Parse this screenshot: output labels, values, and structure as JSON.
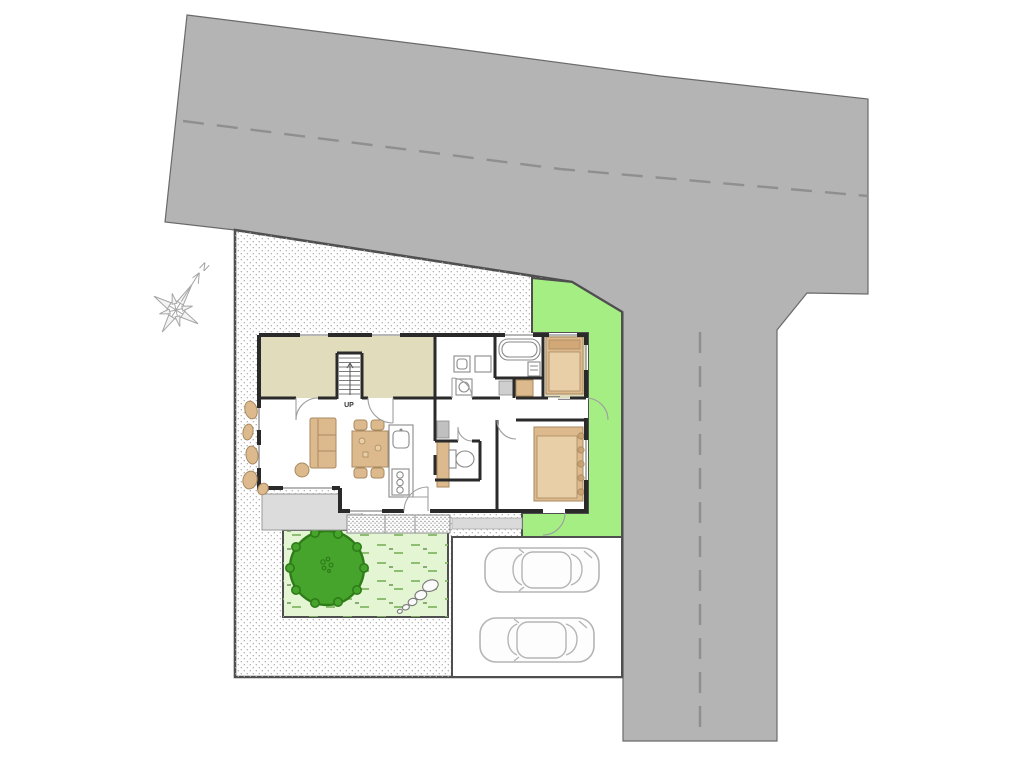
{
  "drawing": {
    "compass_label": "N",
    "stairs_label": "UP"
  },
  "palette": {
    "road": "#b4b4b4",
    "road_line": "#8f8f8f",
    "outline": "#4f4f4f",
    "outline_soft": "#6a6a6a",
    "site_dot": "#a8a8a8",
    "green": "#a5ee84",
    "lawn": "#e3f5d3",
    "lawn_mark": "#7fb560",
    "tree": "#46a42c",
    "tree_edge": "#2e7d18",
    "beige": "#e0dcbc",
    "tan": "#dcba8e",
    "tan_edge": "#a8895f",
    "tan_light": "#e9cfa8",
    "wall": "#2a2a2a",
    "porch": "#dcdcdc",
    "hatch": "#cfcfcf",
    "car": "#b5b5b5"
  }
}
